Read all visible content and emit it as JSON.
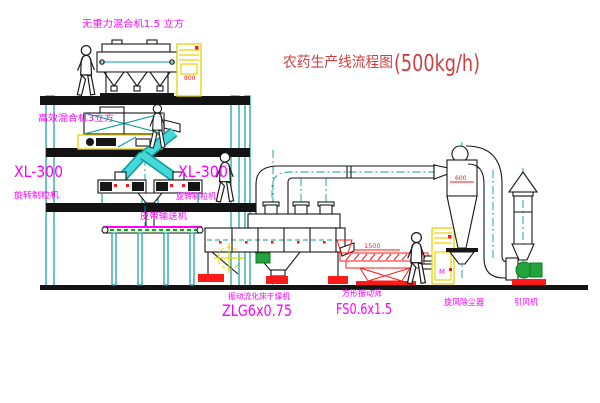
{
  "title": {
    "text": "农药生产线流程图",
    "capacity": "(500kg/h)"
  },
  "equipment": {
    "gravity_mixer": {
      "label": "无重力混合机1.5 立方"
    },
    "high_mixer": {
      "label": "高效混合机3立方"
    },
    "granulator_left": {
      "model": "XL-300",
      "label": "旋转制粒机"
    },
    "granulator_right": {
      "model": "XL-300",
      "label": "旋转制粒机"
    },
    "belt_conveyor": {
      "label": "皮带输送机"
    },
    "dryer": {
      "label": "振动流化床干燥机",
      "model": "ZLG6x0.75"
    },
    "sieve": {
      "label": "方形振动筛",
      "model": "FS0.6x1.5",
      "dim_width": "1500",
      "dim_height": "340"
    },
    "cyclone": {
      "label": "旋风除尘器",
      "dim": "600"
    },
    "fan": {
      "label": "引风机"
    },
    "cabinet_top": {
      "mark": "800"
    },
    "cabinet_floor": {
      "mark": "M"
    }
  },
  "colors": {
    "line_teal": "#0a9c9c",
    "chute_cyan": "#45d8d8",
    "label_magenta": "#ff00ff",
    "dim_red": "#ff1a1a",
    "title_red": "#cc4040",
    "cabinet_yellow": "#e8d400",
    "valve_green": "#23a33c",
    "ink_black": "#161616"
  }
}
